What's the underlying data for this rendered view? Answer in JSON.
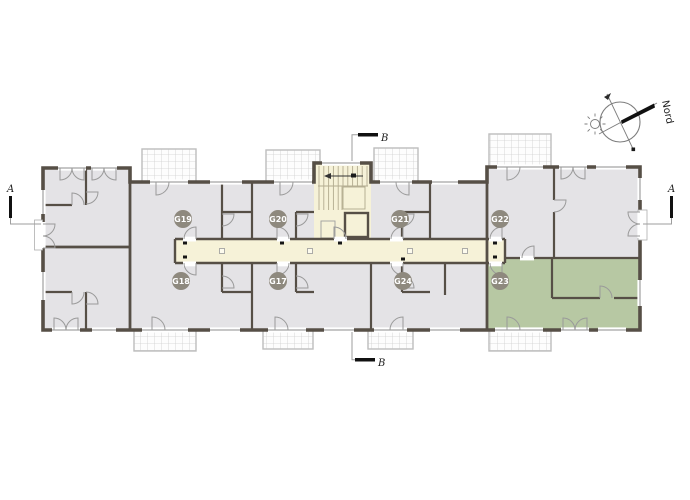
{
  "drawing": {
    "type": "apartment-floor-plan",
    "compass": {
      "north_label": "Nord"
    },
    "section_markers": {
      "left": "A",
      "right": "A",
      "top": "B",
      "bottom": "B"
    },
    "apartments": [
      {
        "code": "G19",
        "row": "top",
        "highlighted": false
      },
      {
        "code": "G20",
        "row": "top",
        "highlighted": false
      },
      {
        "code": "G21",
        "row": "top",
        "highlighted": false
      },
      {
        "code": "G22",
        "row": "top",
        "highlighted": false
      },
      {
        "code": "G18",
        "row": "bottom",
        "highlighted": false
      },
      {
        "code": "G17",
        "row": "bottom",
        "highlighted": false
      },
      {
        "code": "G24",
        "row": "bottom",
        "highlighted": false
      },
      {
        "code": "G23",
        "row": "bottom",
        "highlighted": true
      }
    ],
    "colors": {
      "wall": "#564f46",
      "room": "#e4e3e6",
      "circulation": "#f6f2d8",
      "highlight": "#b7c8a3",
      "badge": "#8e897e",
      "balcony_line": "#c2c2c2"
    }
  }
}
